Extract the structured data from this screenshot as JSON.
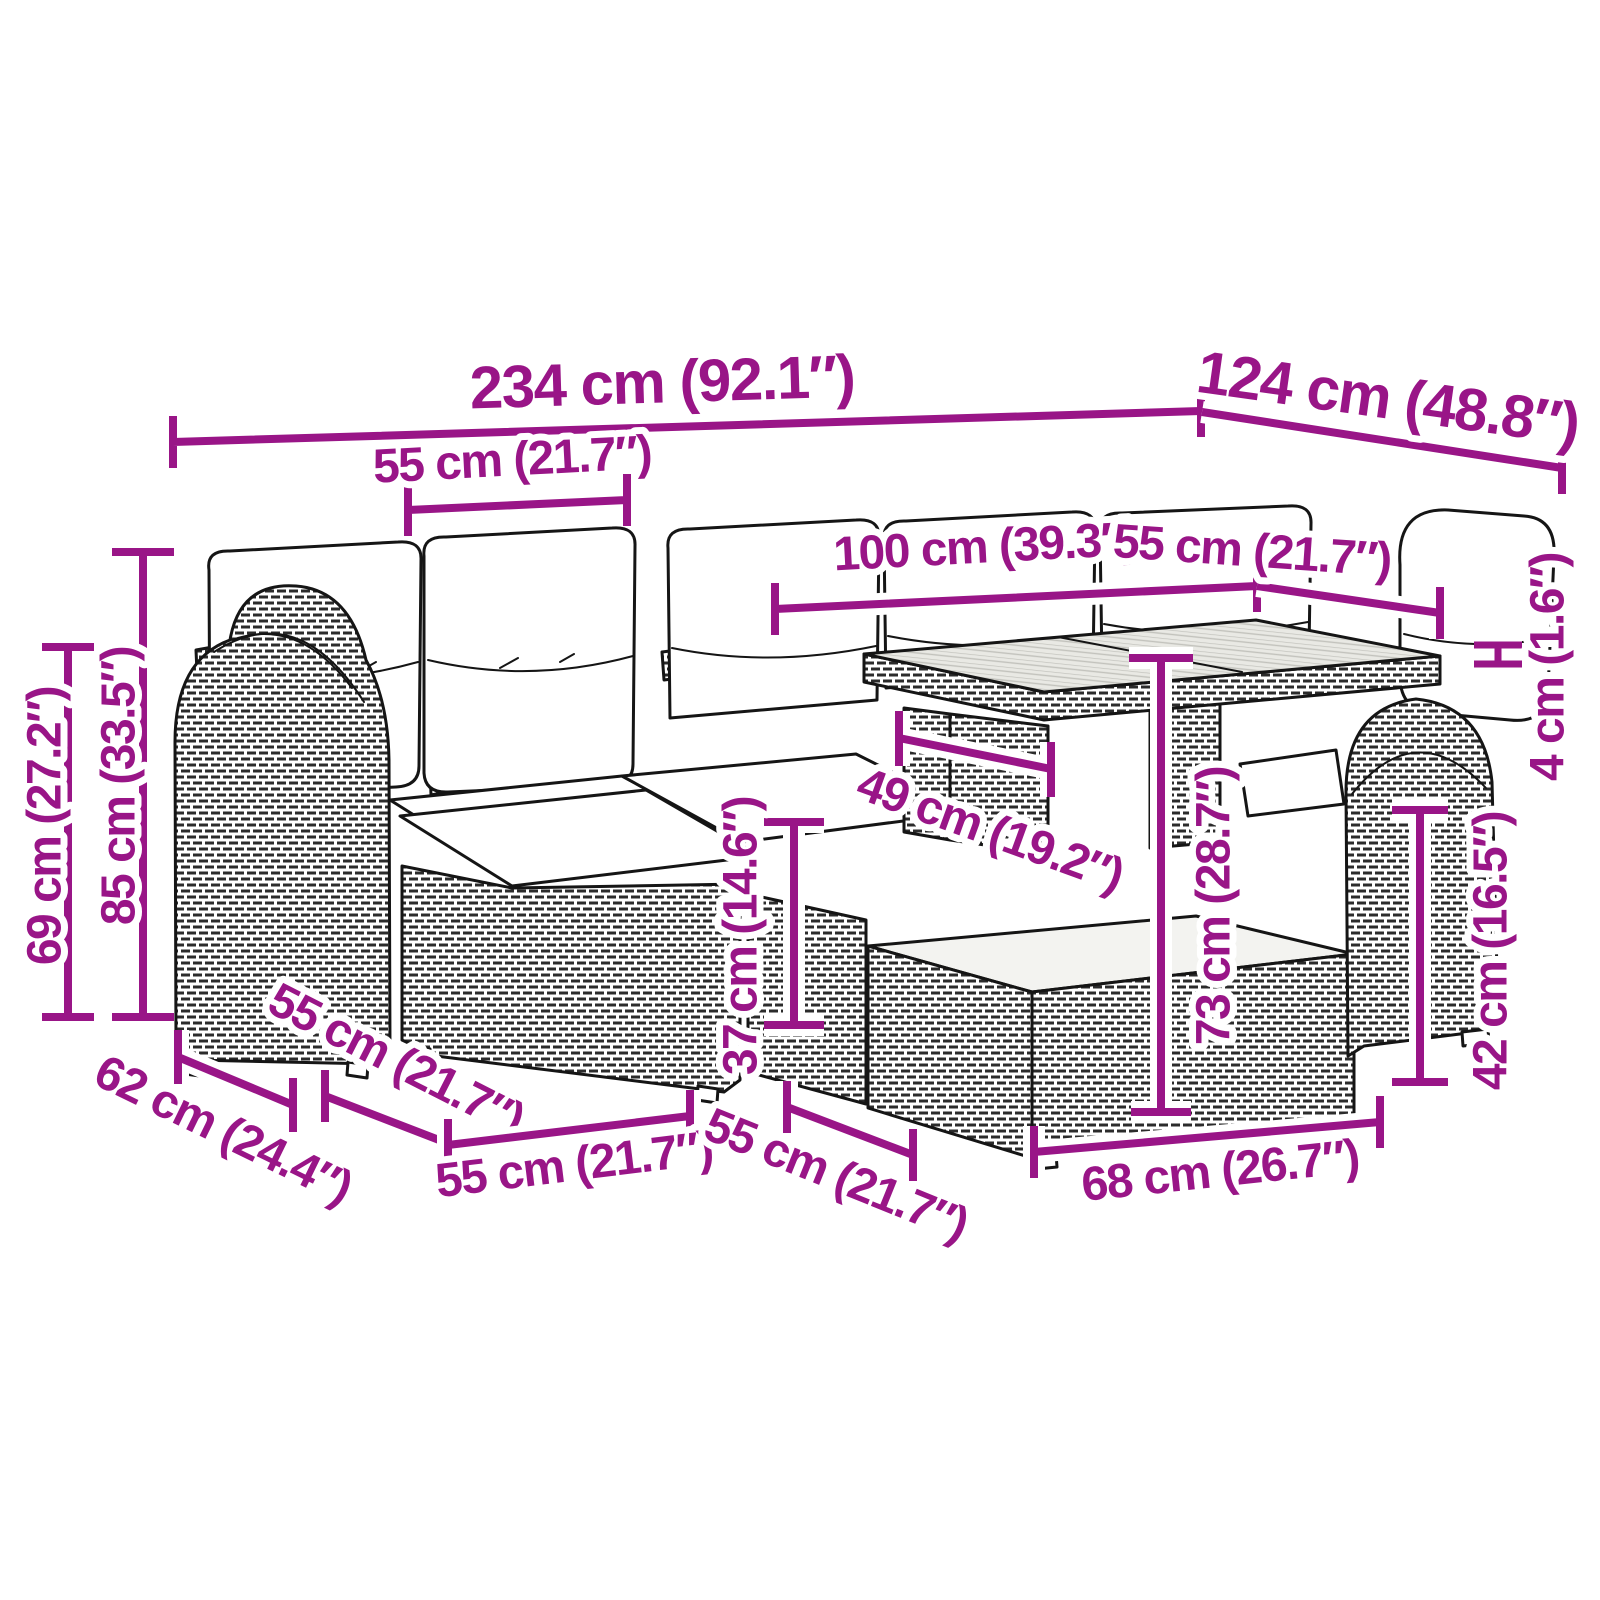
{
  "diagram": {
    "type": "product-dimension-diagram",
    "subject": "rattan garden lounge set with table, ottomans and cushions",
    "accent_color": "#991587",
    "drawing_color": "#151515",
    "background_color": "#ffffff"
  },
  "dims": {
    "overall_width": "234 cm (92.1″)",
    "overall_depth": "124 cm (48.8″)",
    "seat_width_top": "55 cm (21.7″)",
    "table_length": "100 cm (39.3″)",
    "table_width": "55 cm (21.7″)",
    "tabletop_thickness": "4 cm (1.6″)",
    "back_height": "85 cm (33.5″)",
    "arm_height": "69 cm (27.2″)",
    "under_table_clearance": "49 cm (19.2″)",
    "ottoman_height": "37 cm (14.6″)",
    "table_height": "73 cm (28.7″)",
    "box_height": "42 cm (16.5″)",
    "seat_depth_side": "62 cm (24.4″)",
    "ottoman_depth_side": "55 cm (21.7″)",
    "ottoman_width_bottom": "55 cm (21.7″)",
    "box_depth_bottom": "55 cm (21.7″)",
    "box_width_bottom": "68 cm (26.7″)"
  }
}
